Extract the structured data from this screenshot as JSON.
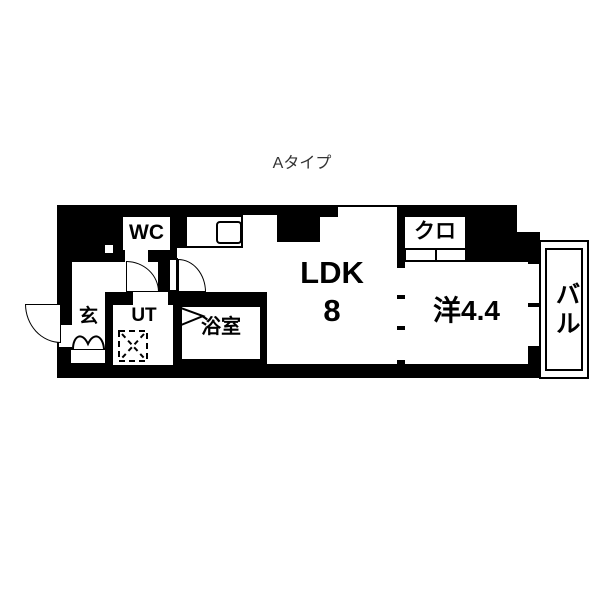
{
  "title": "Aタイプ",
  "rooms": {
    "ldk": {
      "label": "LDK",
      "size": "8"
    },
    "western": {
      "label": "洋4.4"
    },
    "closet": {
      "label": "クロ"
    },
    "wc": {
      "label": "WC"
    },
    "utility": {
      "label": "UT"
    },
    "bathroom": {
      "label": "浴室"
    },
    "entrance": {
      "label": "玄"
    },
    "balcony": {
      "label": "バル"
    }
  },
  "colors": {
    "wall": "#000000",
    "floor": "#ffffff",
    "label_text": "#000000",
    "title_text": "#333333"
  }
}
